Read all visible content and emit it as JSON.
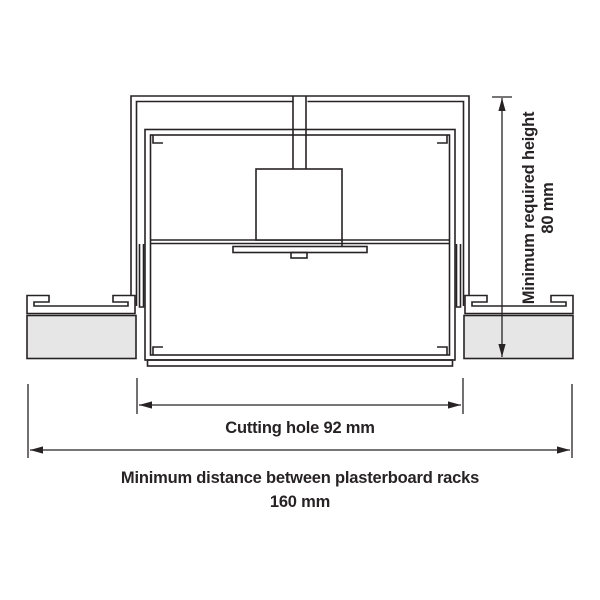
{
  "figure": {
    "type": "technical-installation-diagram",
    "subject": "recessed-fixture-in-plasterboard-ceiling-cross-section",
    "labels": {
      "height_line1": "Minimum required height",
      "height_line2": "80 mm",
      "cutting_hole": "Cutting hole 92 mm",
      "rack_distance_line1": "Minimum distance between plasterboard racks",
      "rack_distance_line2": "160 mm"
    },
    "dimensions": {
      "minimum_required_height_mm": 80,
      "cutting_hole_mm": 92,
      "rack_distance_mm": 160
    },
    "colors": {
      "line": "#272324",
      "plasterboard_fill": "#e6e6e7",
      "background": "#ffffff"
    }
  }
}
